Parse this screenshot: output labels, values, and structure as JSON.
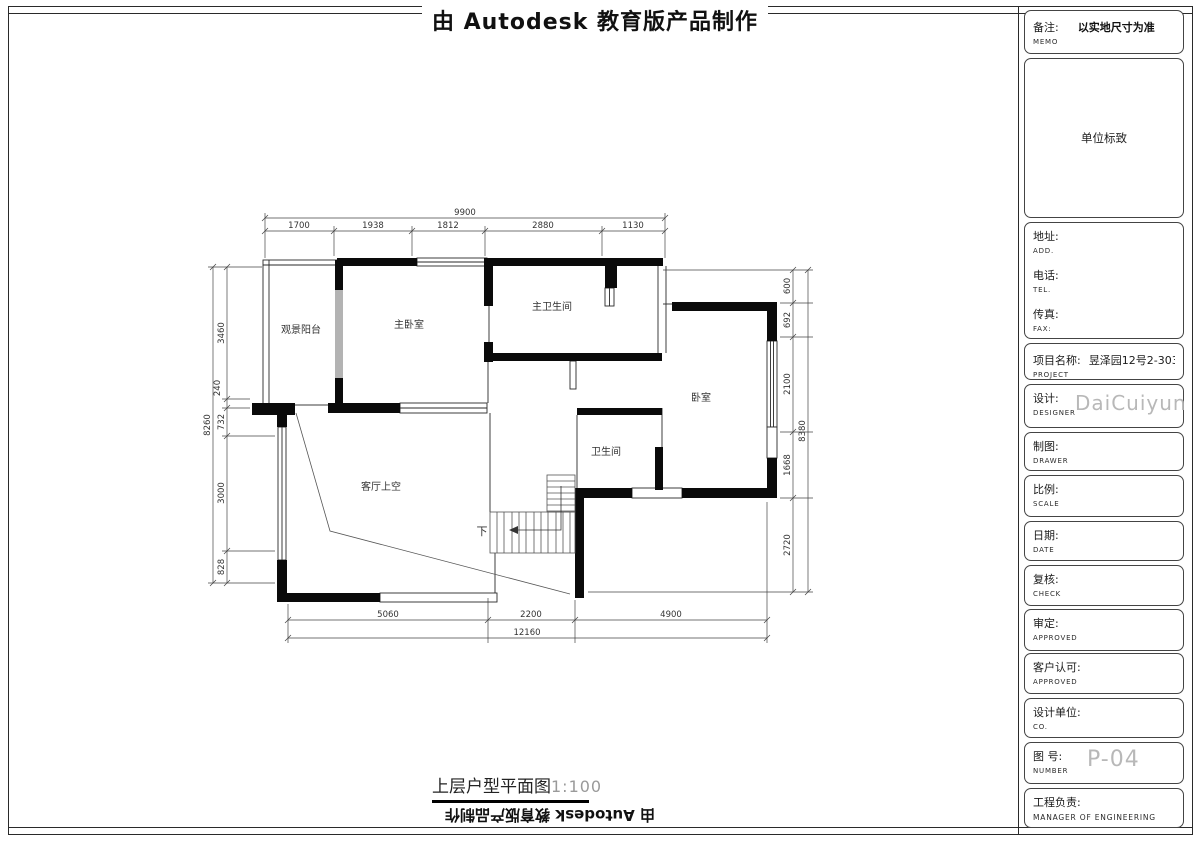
{
  "header": {
    "title": "由 Autodesk 教育版产品制作"
  },
  "footer": {
    "plan_title": "上层户型平面图",
    "plan_scale": "1:100",
    "mirrored_title": "由 Autodesk 教育版产品制作"
  },
  "plan": {
    "rooms": {
      "balcony": "观景阳台",
      "master_bedroom": "主卧室",
      "master_bath": "主卫生间",
      "bedroom": "卧室",
      "bath": "卫生间",
      "living_void": "客厅上空",
      "stairs_down": "下"
    },
    "dims": {
      "top": {
        "total": "9900",
        "segments": [
          "1700",
          "1938",
          "1812",
          "2880",
          "1130"
        ]
      },
      "left": {
        "total": "8260",
        "segments": [
          "3460",
          "240",
          "732",
          "3000",
          "828"
        ]
      },
      "right": {
        "total": "8380",
        "segments": [
          "600",
          "692",
          "2100",
          "1668",
          "2720"
        ]
      },
      "bottom": {
        "total": "12160",
        "segments": [
          "5060",
          "2200",
          "4900"
        ]
      }
    }
  },
  "titleblock": {
    "memo": {
      "label": "备注:",
      "sub": "MEMO",
      "value": "以实地尺寸为准"
    },
    "logo": {
      "value": "单位标致"
    },
    "address": {
      "label": "地址:",
      "sub": "ADD."
    },
    "tel": {
      "label": "电话:",
      "sub": "TEL."
    },
    "fax": {
      "label": "传真:",
      "sub": "FAX:"
    },
    "project": {
      "label": "项目名称:",
      "sub": "PROJECT",
      "value": "昱泽园12号2-303—"
    },
    "designer": {
      "label": "设计:",
      "sub": "DESIGNER",
      "value": "DaiCuiyun"
    },
    "drawer": {
      "label": "制图:",
      "sub": "DRAWER"
    },
    "scale": {
      "label": "比例:",
      "sub": "SCALE"
    },
    "date": {
      "label": "日期:",
      "sub": "DATE"
    },
    "check": {
      "label": "复核:",
      "sub": "CHECK"
    },
    "approve": {
      "label": "审定:",
      "sub": "APPROVED"
    },
    "client": {
      "label": "客户认可:",
      "sub": "APPROVED"
    },
    "company": {
      "label": "设计单位:",
      "sub": "CO."
    },
    "number": {
      "label": "图  号:",
      "sub": "NUMBER",
      "value": "P-04"
    },
    "manager": {
      "label": "工程负责:",
      "sub": "MANAGER OF ENGINEERING"
    }
  },
  "colors": {
    "wall": "#0a0a0a",
    "window_gray": "#b3b3b3",
    "ghost_text": "#b8b8b8",
    "dim_text": "#333333"
  }
}
